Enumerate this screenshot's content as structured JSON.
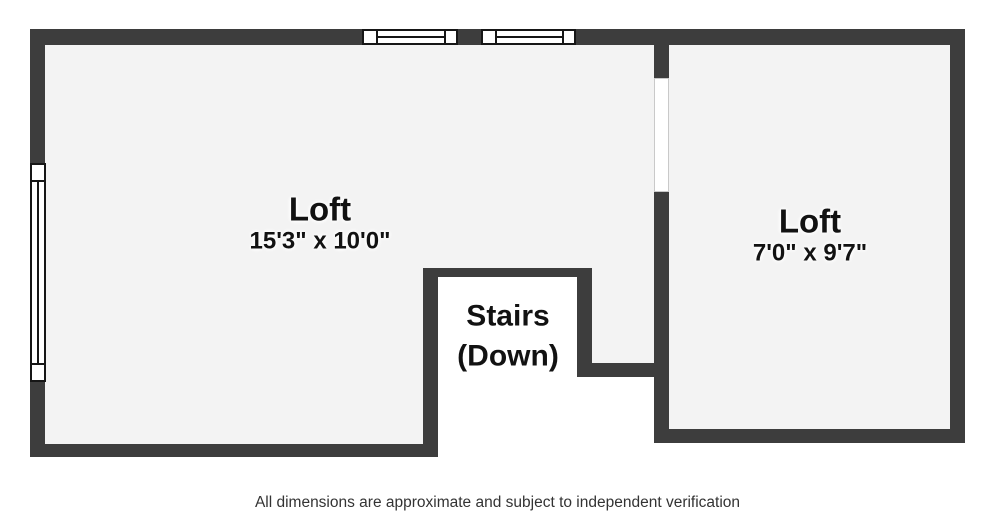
{
  "page": {
    "background": "#ffffff",
    "disclaimer": "All dimensions are approximate and subject to independent verification"
  },
  "floorplan": {
    "wall_color": "#3d3d3d",
    "floor_color": "#f3f3f3",
    "stairs_fill_color": "#ffffff",
    "label_color": "#121212",
    "rooms": [
      {
        "id": "loft-main",
        "name": "Loft",
        "dimensions": "15'3\" x 10'0\""
      },
      {
        "id": "loft-small",
        "name": "Loft",
        "dimensions": "7'0\" x 9'7\""
      }
    ],
    "stairs": {
      "line1": "Stairs",
      "line2": "(Down)"
    }
  }
}
